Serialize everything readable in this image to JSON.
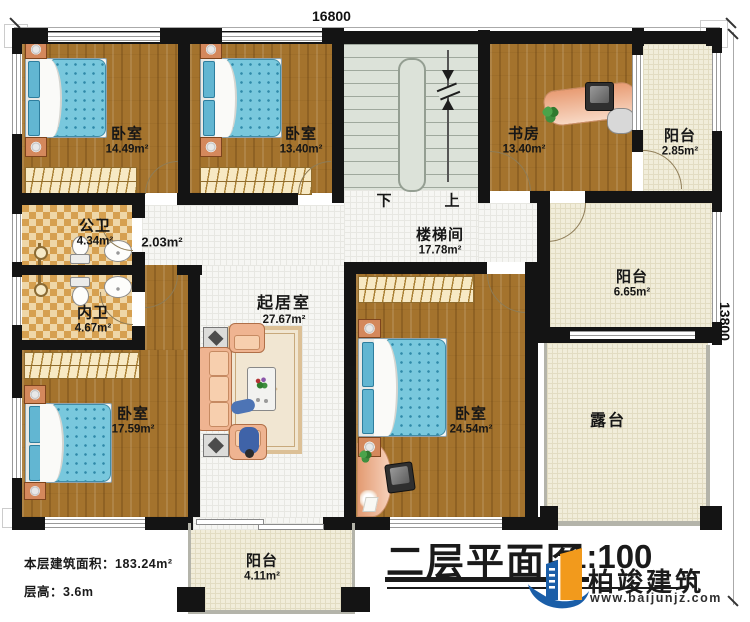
{
  "dimensions": {
    "width_label": "16800",
    "height_label": "13800"
  },
  "stairs": {
    "down": "下",
    "up": "上"
  },
  "rooms": {
    "bedroom_nw": {
      "name": "卧室",
      "area": "14.49m²"
    },
    "bedroom_n": {
      "name": "卧室",
      "area": "13.40m²"
    },
    "study": {
      "name": "书房",
      "area": "13.40m²"
    },
    "balcony_ne": {
      "name": "阳台",
      "area": "2.85m²"
    },
    "stairwell": {
      "name": "楼梯间",
      "area": "17.78m²"
    },
    "corridor": {
      "area": "2.03m²"
    },
    "bath_public": {
      "name": "公卫",
      "area": "4.34m²"
    },
    "bath_private": {
      "name": "内卫",
      "area": "4.67m²"
    },
    "living": {
      "name": "起居室",
      "area": "27.67m²"
    },
    "bedroom_sw": {
      "name": "卧室",
      "area": "17.59m²"
    },
    "bedroom_se": {
      "name": "卧室",
      "area": "24.54m²"
    },
    "balcony_e": {
      "name": "阳台",
      "area": "6.65m²"
    },
    "terrace": {
      "name": "露台"
    },
    "balcony_s": {
      "name": "阳台",
      "area": "4.11m²"
    }
  },
  "info": {
    "floor_area": "本层建筑面积：183.24m²",
    "floor_height": "层高：3.6m"
  },
  "title_block": {
    "title": "二层平面图",
    "scale": "1:100"
  },
  "brand": {
    "name": "柏竣建筑",
    "website": "www.baijunjz.com"
  },
  "colors": {
    "wall": "#141414",
    "wood_floor": "#a4732d",
    "tile_cream": "#f1edda",
    "bed_blue": "#79c8dd",
    "sofa_peach": "#efb491",
    "brand_blue": "#1a5ea8",
    "brand_orange": "#f29a1c"
  }
}
